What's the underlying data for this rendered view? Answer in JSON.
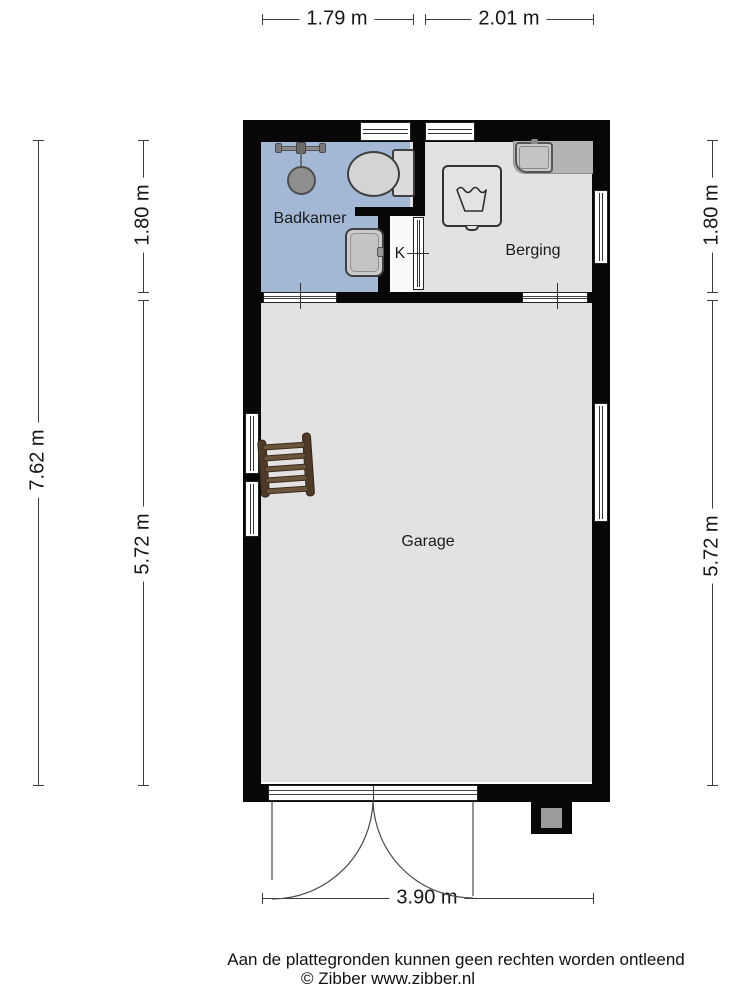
{
  "page": {
    "background": "#ffffff"
  },
  "floorplan": {
    "wall_color": "#070707",
    "rooms": [
      {
        "id": "badkamer",
        "label": "Badkamer",
        "floor_color": "#a3b8d5"
      },
      {
        "id": "k",
        "label": "K",
        "floor_color": "#fafafa"
      },
      {
        "id": "berging",
        "label": "Berging",
        "floor_color": "#e2e2e2"
      },
      {
        "id": "garage",
        "label": "Garage",
        "floor_color": "#e2e2e2"
      }
    ],
    "fixtures": [
      {
        "id": "shower",
        "room": "badkamer"
      },
      {
        "id": "toilet",
        "room": "badkamer"
      },
      {
        "id": "washbasin",
        "room": "badkamer"
      },
      {
        "id": "counter-sink",
        "room": "berging"
      },
      {
        "id": "washing-machine",
        "room": "berging"
      },
      {
        "id": "ladder",
        "room": "garage"
      },
      {
        "id": "double-garage-door",
        "room": "garage"
      },
      {
        "id": "chimney",
        "room": "exterior"
      }
    ]
  },
  "dimensions": {
    "top": [
      {
        "label": "1.79 m"
      },
      {
        "label": "2.01 m"
      }
    ],
    "left_outer": {
      "label": "7.62 m"
    },
    "left_inner": [
      {
        "label": "1.80 m"
      },
      {
        "label": "5.72 m"
      }
    ],
    "right": [
      {
        "label": "1.80 m"
      },
      {
        "label": "5.72 m"
      }
    ],
    "bottom": {
      "label": "3.90 m"
    }
  },
  "caption": {
    "line1": "Aan de plattegronden kunnen geen rechten worden ontleend",
    "line2": "© Zibber www.zibber.nl"
  }
}
